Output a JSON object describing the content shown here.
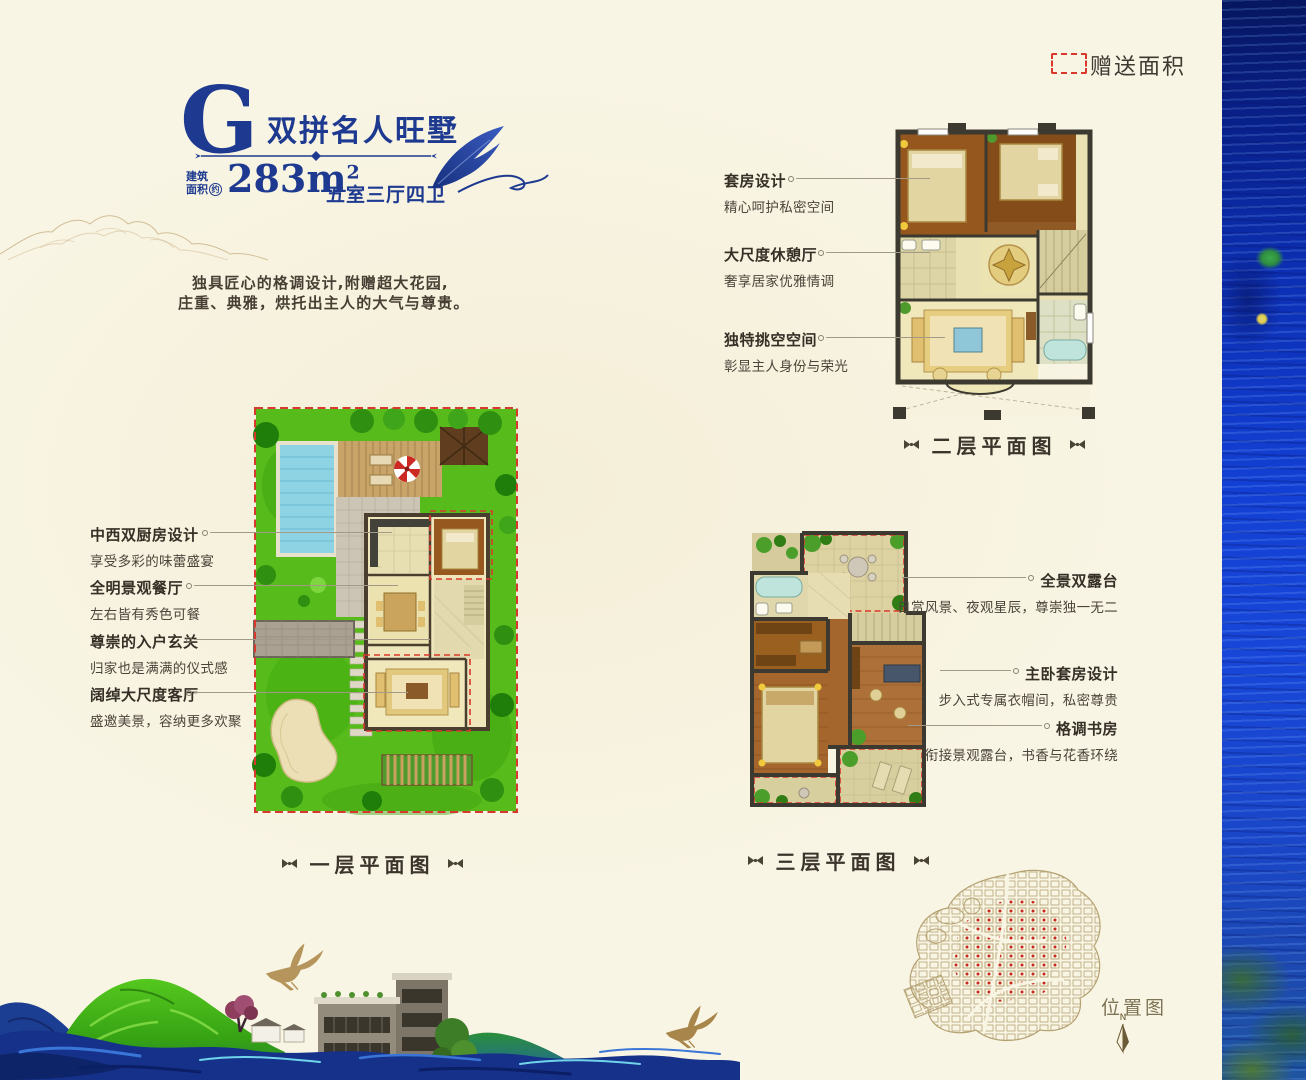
{
  "page": {
    "bg_color": "#f9f5e4"
  },
  "header": {
    "letter": "G",
    "name": "双拼名人旺墅",
    "area_label_line1": "建筑",
    "area_label_line2": "面积",
    "area_approx": "约",
    "area_value": "283m",
    "area_exponent": "2",
    "rooms": "五室三厅四卫",
    "desc_line1": "独具匠心的格调设计,附赠超大花园,",
    "desc_line2": "庄重、典雅，烘托出主人的大气与尊贵。"
  },
  "legend": {
    "label": "赠送面积",
    "color": "#d8392c"
  },
  "floor2": {
    "caption": "二层平面图",
    "annotations": [
      {
        "title": "套房设计",
        "desc": "精心呵护私密空间"
      },
      {
        "title": "大尺度休憩厅",
        "desc": "奢享居家优雅情调"
      },
      {
        "title": "独特挑空空间",
        "desc": "彰显主人身份与荣光"
      }
    ]
  },
  "floor1": {
    "caption": "一层平面图",
    "annotations": [
      {
        "title": "中西双厨房设计",
        "desc": "享受多彩的味蕾盛宴"
      },
      {
        "title": "全明景观餐厅",
        "desc": "左右皆有秀色可餐"
      },
      {
        "title": "尊崇的入户玄关",
        "desc": "归家也是满满的仪式感"
      },
      {
        "title": "阔绰大尺度客厅",
        "desc": "盛邀美景，容纳更多欢聚"
      }
    ]
  },
  "floor3": {
    "caption": "三层平面图",
    "annotations": [
      {
        "title": "全景双露台",
        "desc": "日赏风景、夜观星辰，尊崇独一无二"
      },
      {
        "title": "主卧套房设计",
        "desc": "步入式专属衣帽间，私密尊贵"
      },
      {
        "title": "格调书房",
        "desc": "衔接景观露台，书香与花香环绕"
      }
    ]
  },
  "site_map": {
    "label": "位置图",
    "compass_letter": "N"
  },
  "colors": {
    "accent_blue": "#1d3a90",
    "legend_red": "#d8392c",
    "text_dark": "#3a342b"
  },
  "icons": {
    "ornament": "bowtie-divider",
    "compass": "north-arrow",
    "feather": "quill-feather",
    "crane": "flying-crane"
  }
}
